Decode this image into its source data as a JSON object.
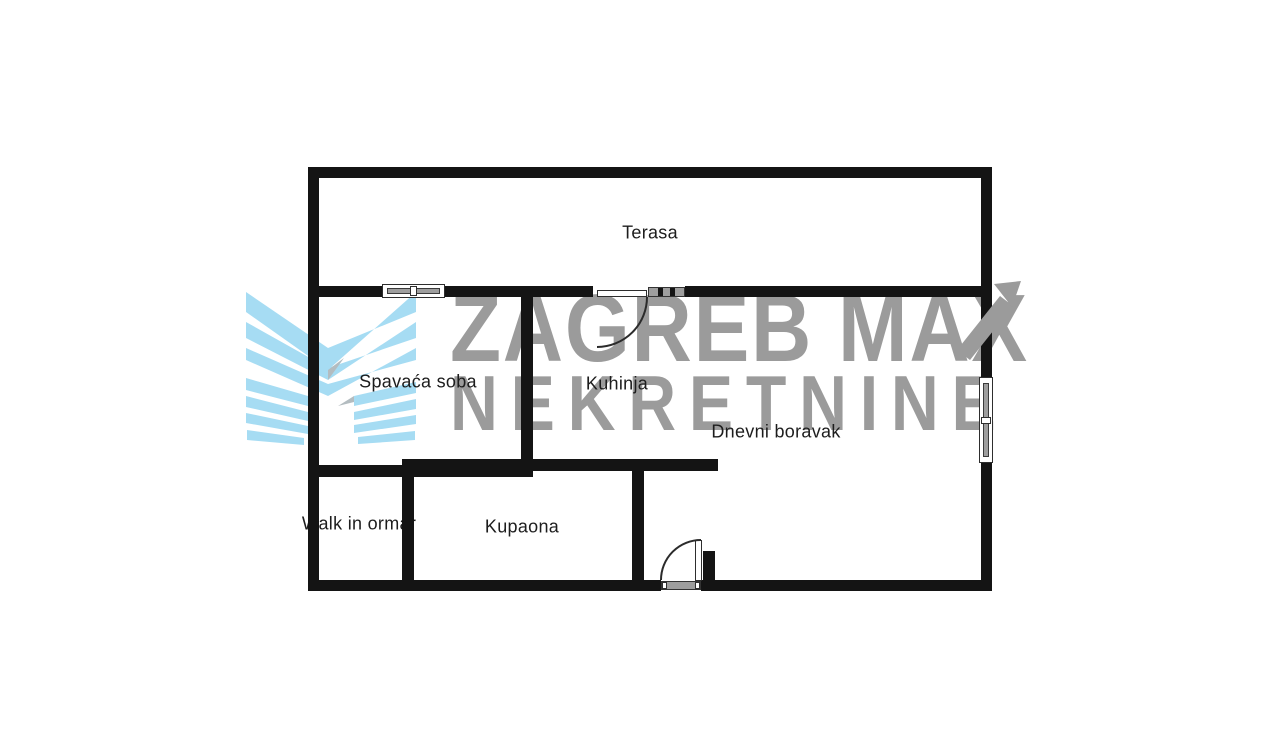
{
  "watermark": {
    "brand_line1": "ZAGREB MAX",
    "brand_line2": "NEKRETNINE",
    "text_color": "#9b9b9b",
    "logo_color": "#a6dcf3",
    "logo_icon": "chevron-wings-logo"
  },
  "floor_plan": {
    "rooms": [
      {
        "label": "Terasa"
      },
      {
        "label": "Spavaća soba"
      },
      {
        "label": "Kuhinja"
      },
      {
        "label": "Dnevni boravak"
      },
      {
        "label": "Walk in ormar"
      },
      {
        "label": "Kupaona"
      }
    ],
    "colors": {
      "wall": "#141414",
      "window_glass": "#9e9e9e",
      "door_line": "#2b2b2b",
      "label_text": "#1d1d1d",
      "background": "#ffffff"
    }
  }
}
